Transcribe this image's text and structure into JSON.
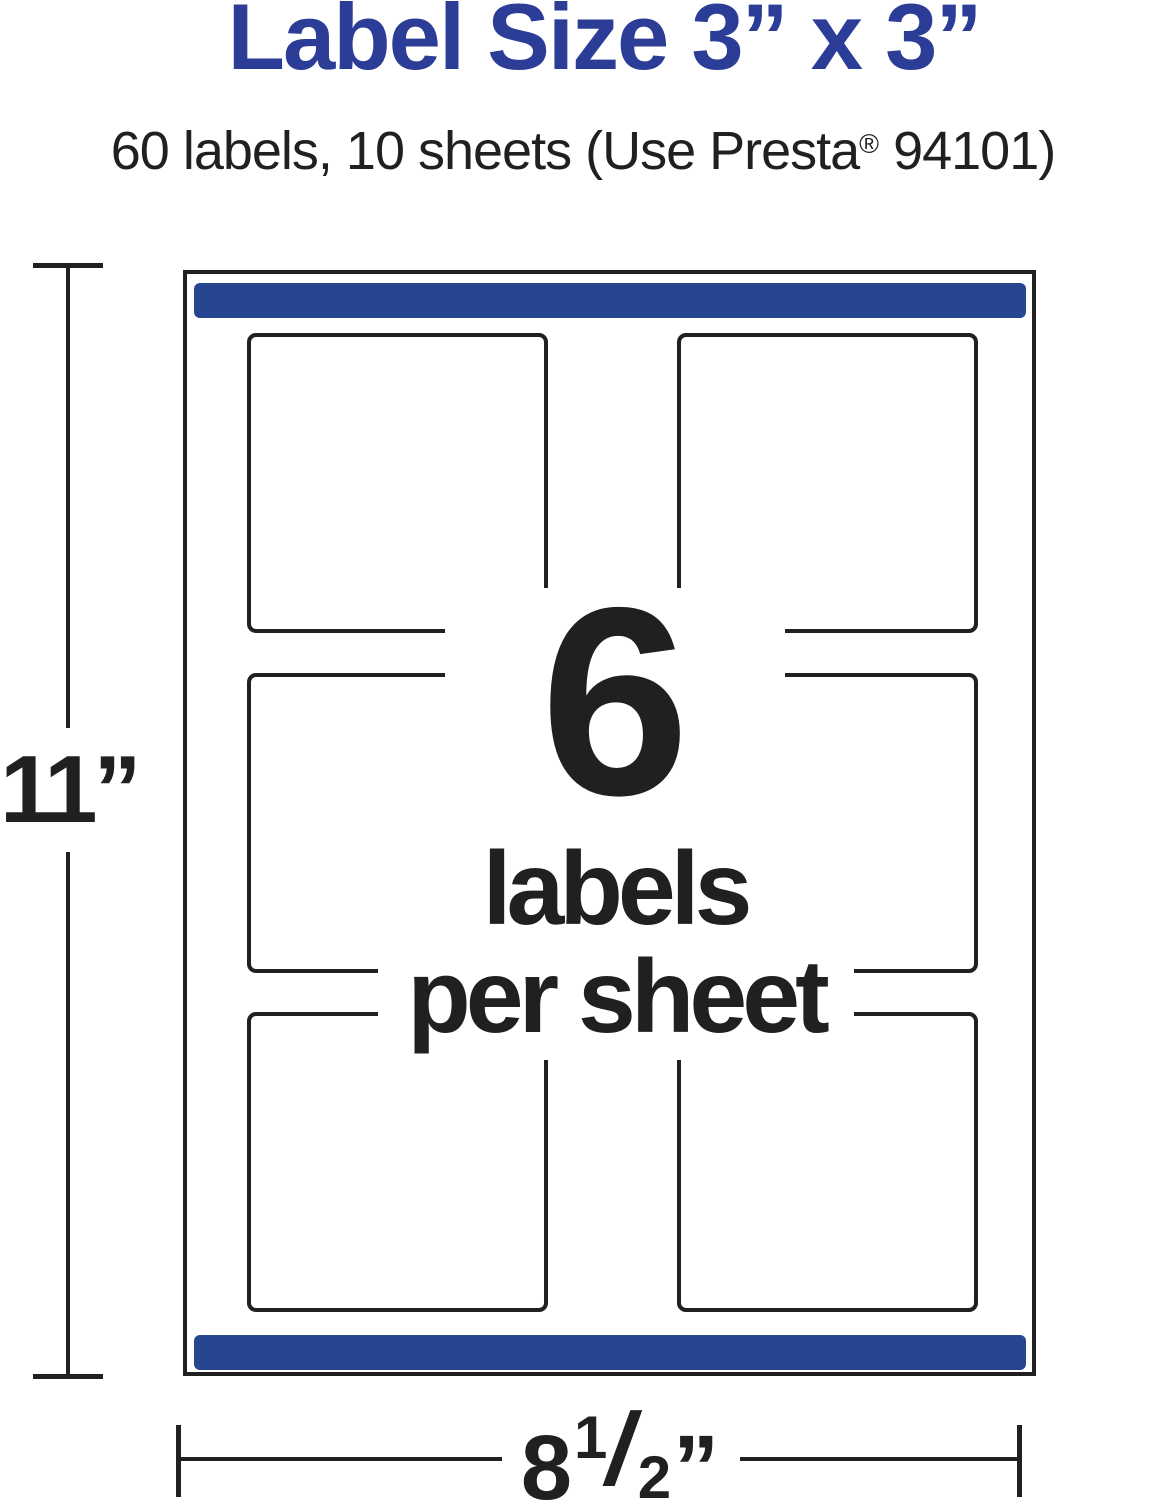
{
  "page": {
    "title": "Label Size 3” x 3”",
    "subtitle_prefix": "60 labels, 10 sheets (Use Presta",
    "subtitle_reg_mark": "®",
    "subtitle_suffix": " 94101)"
  },
  "diagram": {
    "count": "6",
    "count_caption_line1": "labels",
    "count_caption_line2": "per sheet",
    "grid": {
      "rows": 3,
      "columns": 2
    },
    "height_dimension_label": "11”",
    "width_dimension": {
      "whole": "8",
      "numerator": "1",
      "slash": "/",
      "denominator": "2",
      "unit": "”"
    }
  },
  "colors": {
    "title_blue": "#2b3d96",
    "bar_blue": "#26478f",
    "ink": "#221f20"
  }
}
